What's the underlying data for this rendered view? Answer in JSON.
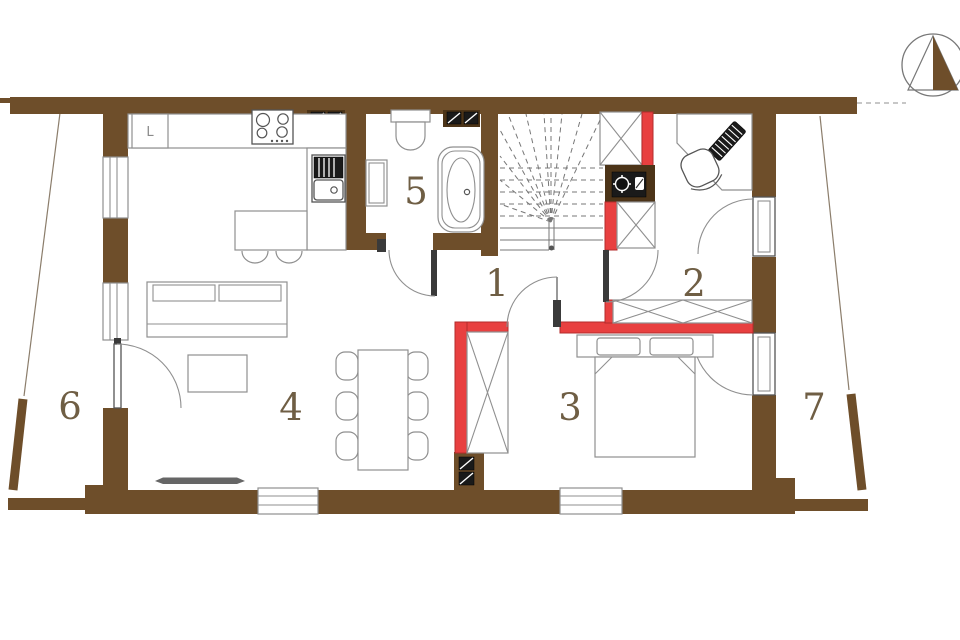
{
  "plan_title": "house-ground-floor-plan",
  "rooms": {
    "r1": "1",
    "r2": "2",
    "r3": "3",
    "r4": "4",
    "r5": "5",
    "r6": "6",
    "r7": "7"
  },
  "kitchen": {
    "fridge_label": "L"
  },
  "colors": {
    "wall": "#6e4e2a",
    "vent_box": "#4c3418",
    "red": "#e84040",
    "red_outline": "#b32b2b",
    "line": "#8f8f8f",
    "label": "#6f5e44",
    "appliance": "#1a1a1a"
  }
}
